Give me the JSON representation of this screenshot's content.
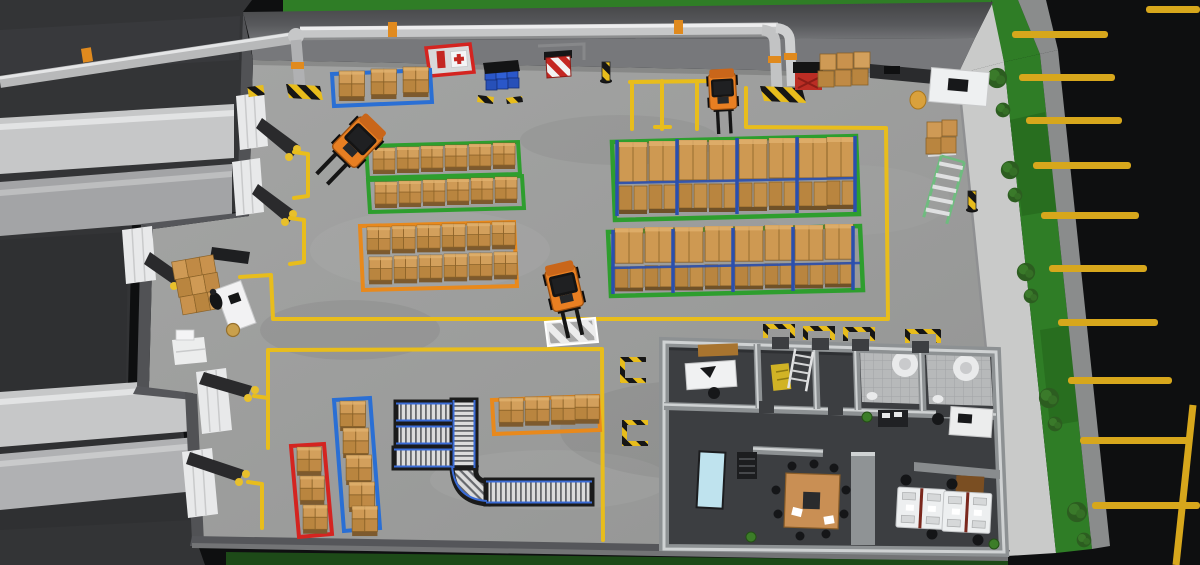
{
  "meta": {
    "scene": "3D warehouse facility layout render",
    "view": "isometric top-down",
    "description": "Rendered warehouse with loading docks and trailers, color-coded pallet storage zones, pallet racking, conveyor system, forklifts, office block with restrooms, overhead piping and exterior parking"
  },
  "palette": {
    "asphalt": "#0e0f10",
    "roof": "#333436",
    "floor": "#9e9f9e",
    "wall_dark": "#47484a",
    "wall_mid": "#515255",
    "wall_inner": "#77787b",
    "wall_white": "#c9cac9",
    "grass": "#2f7d26",
    "grass_dark": "#1d4a18",
    "curb": "#8a8c8c",
    "line_yellow": "#e8bd1c",
    "zone_green": "#2e9e2e",
    "zone_orange": "#e8891c",
    "zone_blue": "#2a6fd4",
    "zone_red": "#d42420",
    "box_brown": "#ce9952",
    "rack_blue": "#2a4fae",
    "forklift_orange": "#e87f22",
    "pipe_silver": "#c6c7c8",
    "pipe_orange": "#e08a1e",
    "hazard_yellow": "#e8bd1c",
    "hazard_black": "#161616",
    "office_floor": "#3c3e41",
    "office_wall": "#8d9193",
    "door_white": "#e8e9ea",
    "conveyor_frame": "#1b1b1b",
    "conveyor_blue": "#3a6bd6",
    "table_wood": "#c98f54",
    "table_blue": "#bfe3ee",
    "bush_green": "#2c5d20",
    "trailer_light": "#c6c7c8",
    "trailer_mid": "#a3a4a6"
  },
  "inventory": {
    "storage_zones": [
      {
        "name": "blue-zone-top",
        "border": "blue",
        "pallets": 3
      },
      {
        "name": "green-zone-1",
        "border": "green",
        "pallets": 6
      },
      {
        "name": "green-zone-2",
        "border": "green",
        "pallets": 6
      },
      {
        "name": "orange-zone-mid",
        "border": "orange",
        "pallets": 12
      },
      {
        "name": "rack-zone-1",
        "border": "green",
        "pallet_bays": 8
      },
      {
        "name": "rack-zone-2",
        "border": "green",
        "pallet_bays": 8
      },
      {
        "name": "orange-zone-bottom",
        "border": "orange",
        "pallets": 4
      },
      {
        "name": "blue-zone-bottom",
        "border": "blue",
        "pallets": 5
      },
      {
        "name": "red-zone-bottom",
        "border": "red",
        "pallets": 3
      }
    ],
    "equipment": {
      "forklifts": 3,
      "conveyor_systems": 1,
      "dock_doors": 6,
      "docked_trailers": 4,
      "rolling_ladder": 1,
      "supply_cart": 1
    },
    "safety": {
      "first_aid_station": 1,
      "fire_extinguisher": 1,
      "hazard_bollards": 2,
      "crosswalk_mats": 1,
      "barrier_sign": 1,
      "hazard_door_markings": 6
    },
    "office": {
      "rooms": [
        "manager-office",
        "storage-room",
        "restroom-1",
        "restroom-2",
        "open-office",
        "meeting-area"
      ],
      "workstations": 2,
      "meeting_table": 1
    },
    "exterior": {
      "parking_stripes": 11,
      "bushes": 10,
      "grass_strips": 3
    }
  }
}
